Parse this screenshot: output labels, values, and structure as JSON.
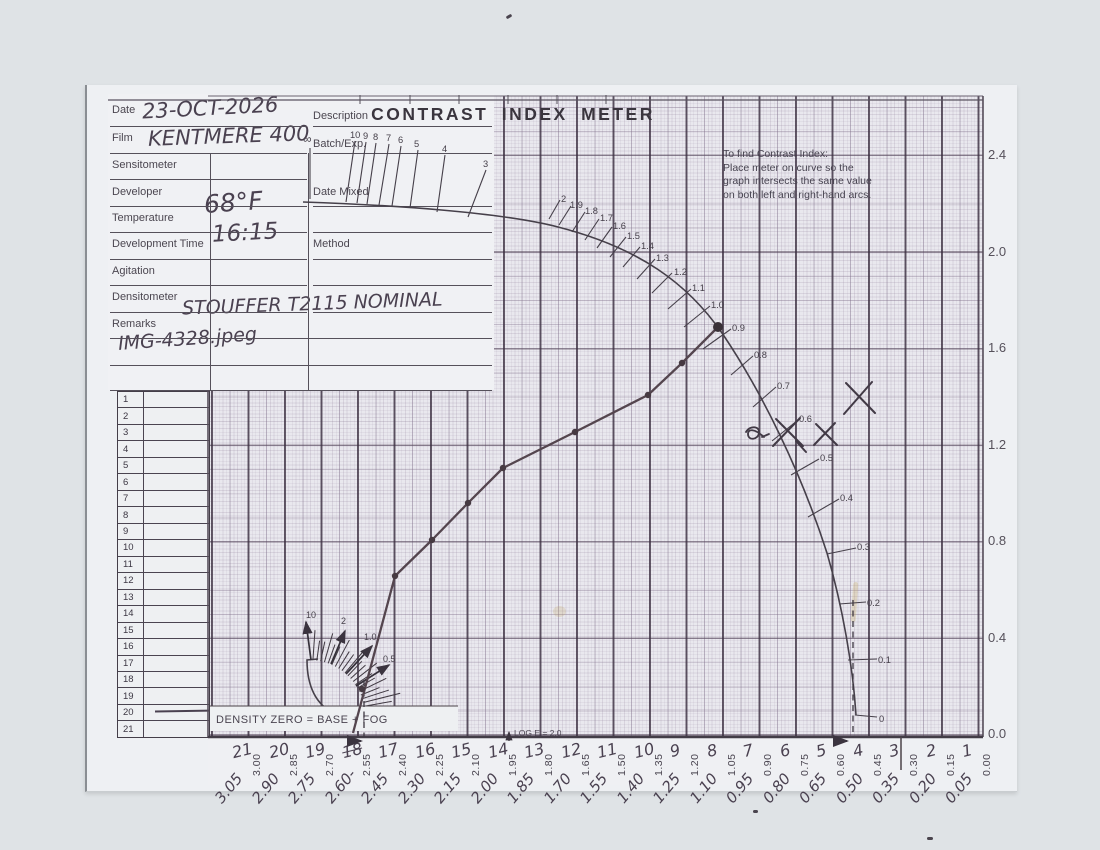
{
  "title": "CONTRAST  INDEX  METER",
  "form": {
    "left_fields": [
      {
        "label": "Date",
        "value": "23-OCT-2026"
      },
      {
        "label": "Film",
        "value": "KENTMERE 400"
      },
      {
        "label": "Sensitometer",
        "value": ""
      },
      {
        "label": "Developer",
        "value": ""
      },
      {
        "label": "Temperature",
        "value": "68°F"
      },
      {
        "label": "Development Time",
        "value": "16:15"
      },
      {
        "label": "Agitation",
        "value": ""
      },
      {
        "label": "Densitometer",
        "value": ""
      },
      {
        "label": "Remarks",
        "value": "STOUFFER T2115 NOMINAL"
      }
    ],
    "remarks_line2": "IMG-4328.jpeg",
    "right_fields": [
      "Description",
      "Batch/Exp.",
      "Date Mixed",
      "Method"
    ]
  },
  "instructions": [
    "To find Contrast Index:",
    "Place meter on curve so the",
    "graph intersects the same value",
    "on both left and right-hand arcs."
  ],
  "labels": {
    "density_zero": "DENSITY ZERO = BASE + FOG",
    "log_e": "LOG E = 2.0"
  },
  "right_axis": [
    "2.4",
    "2.0",
    "1.6",
    "1.2",
    "0.8",
    "0.4",
    "0.0"
  ],
  "bottom_axis": {
    "steps": [
      "21",
      "20",
      "19",
      "18",
      "17",
      "16",
      "15",
      "14",
      "13",
      "12",
      "11",
      "10",
      "9",
      "8",
      "7",
      "6",
      "5",
      "4",
      "3",
      "2",
      "1"
    ],
    "struck_step": "18",
    "printed": [
      "3.00",
      "2.85",
      "2.70",
      "2.55",
      "2.40",
      "2.25",
      "2.10",
      "1.95",
      "1.80",
      "1.65",
      "1.50",
      "1.35",
      "1.20",
      "1.05",
      "0.90",
      "0.75",
      "0.60",
      "0.45",
      "0.30",
      "0.15",
      "0.00"
    ],
    "handwritten": [
      "3.05",
      "2.90",
      "2.75",
      "2.60-",
      "2.45",
      "2.30",
      "2.15",
      "2.00",
      "1.85",
      "1.70",
      "1.55",
      "1.40",
      "1.25",
      "1.10",
      "0.95",
      "0.80",
      "0.65",
      "0.50",
      "0.35",
      "0.20",
      "0.05"
    ]
  },
  "left_table_rows": [
    "1",
    "2",
    "3",
    "4",
    "5",
    "6",
    "7",
    "8",
    "9",
    "10",
    "11",
    "12",
    "13",
    "14",
    "15",
    "16",
    "17",
    "18",
    "19",
    "20",
    "21"
  ],
  "meter": {
    "outer_arc_labels": [
      "2",
      "1.9",
      "1.8",
      "1.7",
      "1.6",
      "1.5",
      "1.4",
      "1.3",
      "1.2",
      "1.1",
      "1.0",
      "0.9",
      "0.8",
      "0.7",
      "0.6",
      "0.5",
      "0.4",
      "0.3",
      "0.2",
      "0.1",
      "0"
    ],
    "top_labels": [
      "∞",
      "10",
      "9",
      "8",
      "7",
      "6",
      "5",
      "4",
      "3"
    ],
    "inner_arc_labels": [
      "10",
      "2",
      "1.0",
      "0.5"
    ]
  },
  "chart_data": {
    "type": "scatter",
    "title": "Film characteristic curve on Contrast Index Meter",
    "xlabel": "Step wedge density / LOG E (decreasing to the right)",
    "ylabel": "Negative density above base + fog",
    "xlim": [
      3.0,
      0.0
    ],
    "ylim": [
      0.0,
      2.4
    ],
    "grid": true,
    "series": [
      {
        "name": "plotted curve points",
        "wedge_steps": [
          17,
          16,
          15,
          14,
          12,
          10,
          9,
          8
        ],
        "x_logE": [
          2.4,
          2.25,
          2.1,
          1.95,
          1.65,
          1.35,
          1.2,
          1.05
        ],
        "y_density": [
          0.66,
          0.81,
          0.96,
          1.11,
          1.25,
          1.41,
          1.54,
          1.69
        ]
      }
    ],
    "toe_start": {
      "x_logE": 2.56,
      "y_density": 0.0
    },
    "contrast_index_reading": 0.9,
    "hand_marked_ci_values": [
      0.55,
      0.55,
      0.6
    ],
    "annotations": [
      "curve end dot on 0.9 arc tick",
      "three pen X marks and one scribble near the 0.5–0.6 arc region",
      "dashed reference lines at wedge step 18 and near step 4"
    ]
  }
}
